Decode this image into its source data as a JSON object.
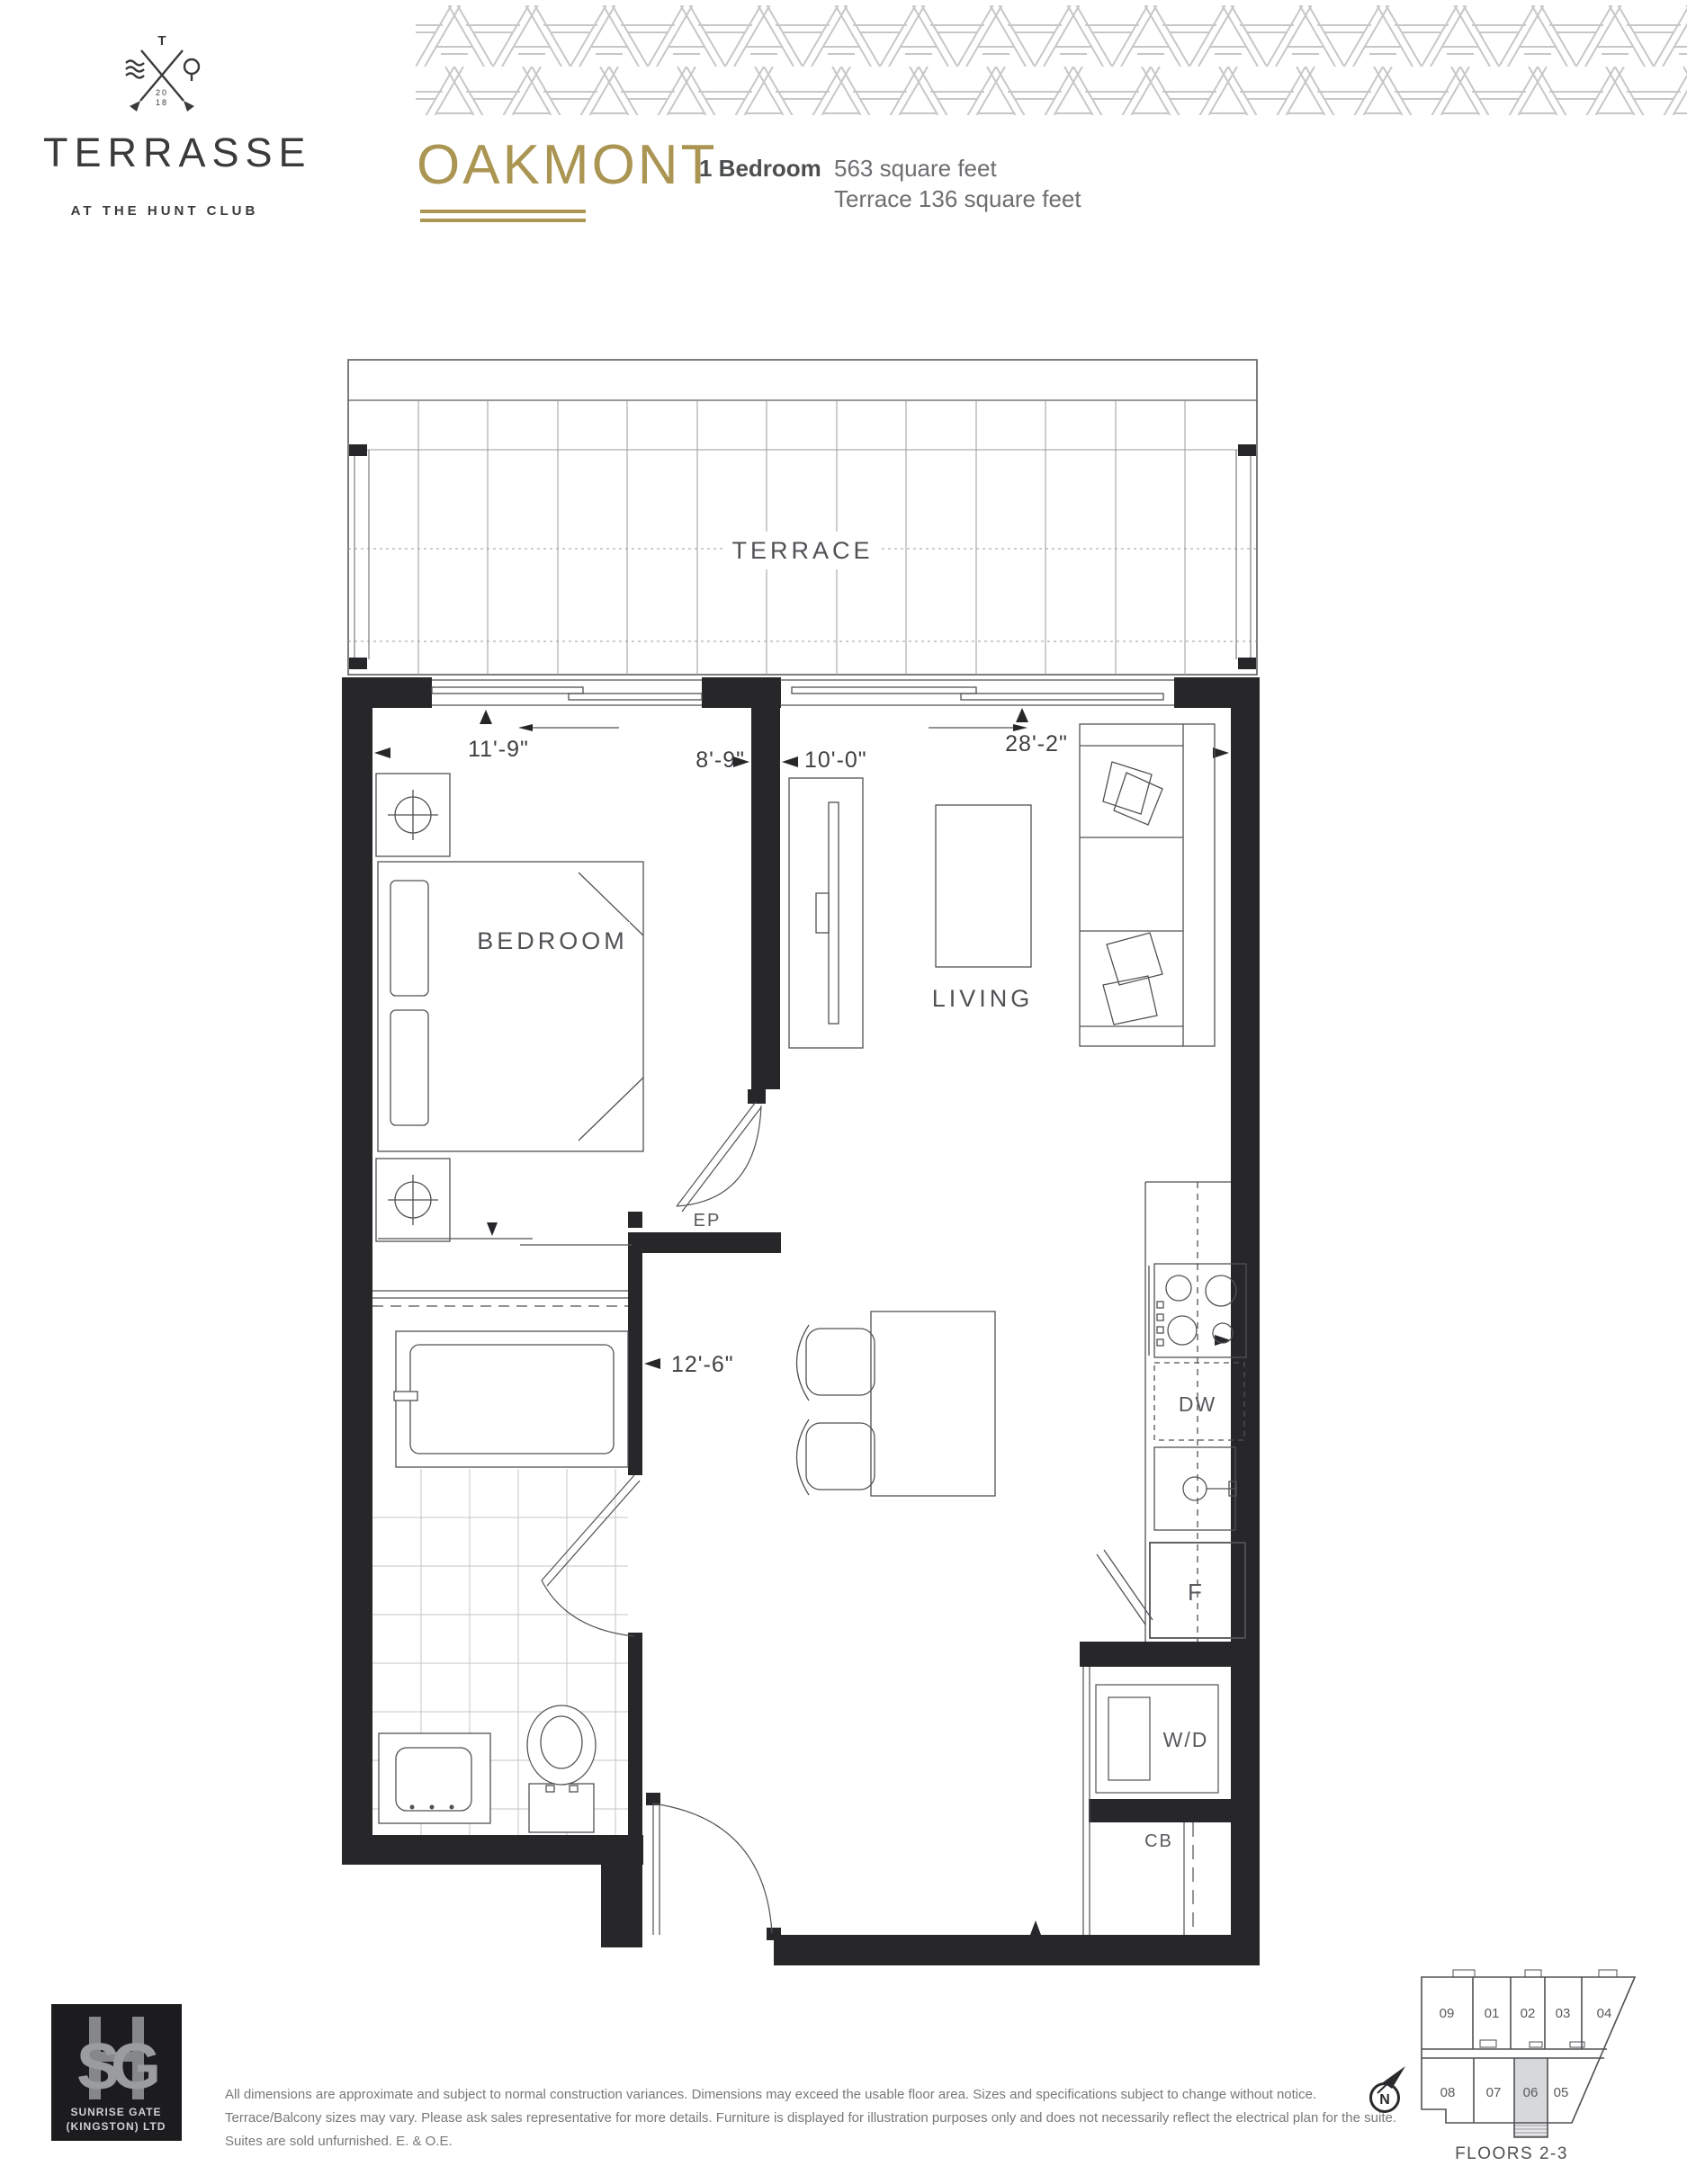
{
  "header": {
    "brand": {
      "wordmark": "TERRASSE",
      "tagline": "AT THE HUNT CLUB",
      "crest_initial": "T",
      "crest_year_top": "20",
      "crest_year_bottom": "18"
    },
    "unit": {
      "name": "OAKMONT",
      "type": "1 Bedroom",
      "area": "563 square feet",
      "terrace_area": "Terrace 136 square feet"
    }
  },
  "plan": {
    "rooms": {
      "terrace": "TERRACE",
      "bedroom": "BEDROOM",
      "living": "LIVING"
    },
    "fixtures": {
      "ep": "EP",
      "dishwasher": "DW",
      "fridge": "F",
      "washer_dryer": "W/D",
      "cb": "CB"
    },
    "dims": {
      "bedroom_window": "11'-9\"",
      "bedroom_depth": "8'-9\"",
      "living_depth": "10'-0\"",
      "overall_width": "28'-2\"",
      "hall_width": "12'-6\""
    }
  },
  "keyplan": {
    "floors_label": "FLOORS 2-3",
    "north_label": "N",
    "suites_top": [
      "09",
      "01",
      "02",
      "03",
      "04"
    ],
    "suites_bottom": [
      "08",
      "07",
      "06",
      "05"
    ],
    "highlighted_suite": "06"
  },
  "footer": {
    "logo": {
      "line1": "SUNRISE GATE",
      "line2": "(KINGSTON) LTD"
    },
    "disclaimer_line1": "All dimensions are approximate and subject to normal construction variances. Dimensions may exceed the usable floor area. Sizes and specifications subject to change without notice.",
    "disclaimer_line2": "Terrace/Balcony sizes may vary. Please ask sales representative for more details. Furniture is displayed for illustration purposes only and does not necessarily reflect the electrical plan for the suite.",
    "disclaimer_line3": "Suites are sold unfurnished. E. & O.E."
  },
  "colors": {
    "gold": "#ab9552",
    "ink": "#3a3a3c",
    "wall": "#27272a",
    "gray_text": "#6d6e71",
    "pattern": "#c7c7c7",
    "highlight": "#d7d8da"
  }
}
